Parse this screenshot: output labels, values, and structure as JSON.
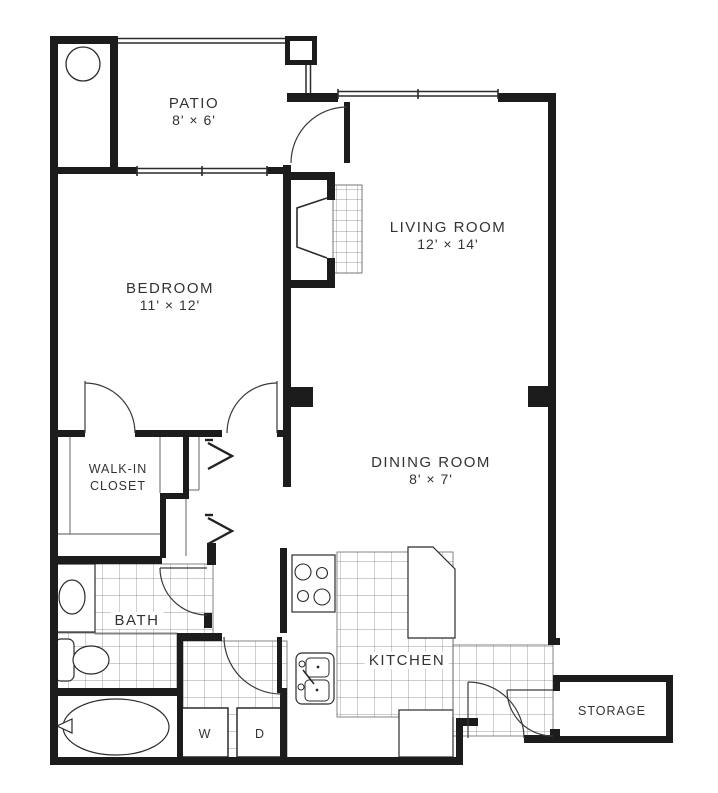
{
  "plan": {
    "rooms": {
      "patio": {
        "name": "PATIO",
        "dims": "8' × 6'"
      },
      "living": {
        "name": "LIVING ROOM",
        "dims": "12' × 14'"
      },
      "bedroom": {
        "name": "BEDROOM",
        "dims": "11' × 12'"
      },
      "closet": {
        "line1": "WALK-IN",
        "line2": "CLOSET"
      },
      "dining": {
        "name": "DINING ROOM",
        "dims": "8' × 7'"
      },
      "bath": {
        "name": "BATH"
      },
      "kitchen": {
        "name": "KITCHEN"
      },
      "storage": {
        "name": "STORAGE"
      },
      "washer": {
        "label": "W"
      },
      "dryer": {
        "label": "D"
      }
    },
    "colors": {
      "wall": "#1c1c1c",
      "line": "#2b2b2b",
      "tile": "#7a7a7a",
      "text": "#333333",
      "bg": "#ffffff"
    }
  }
}
